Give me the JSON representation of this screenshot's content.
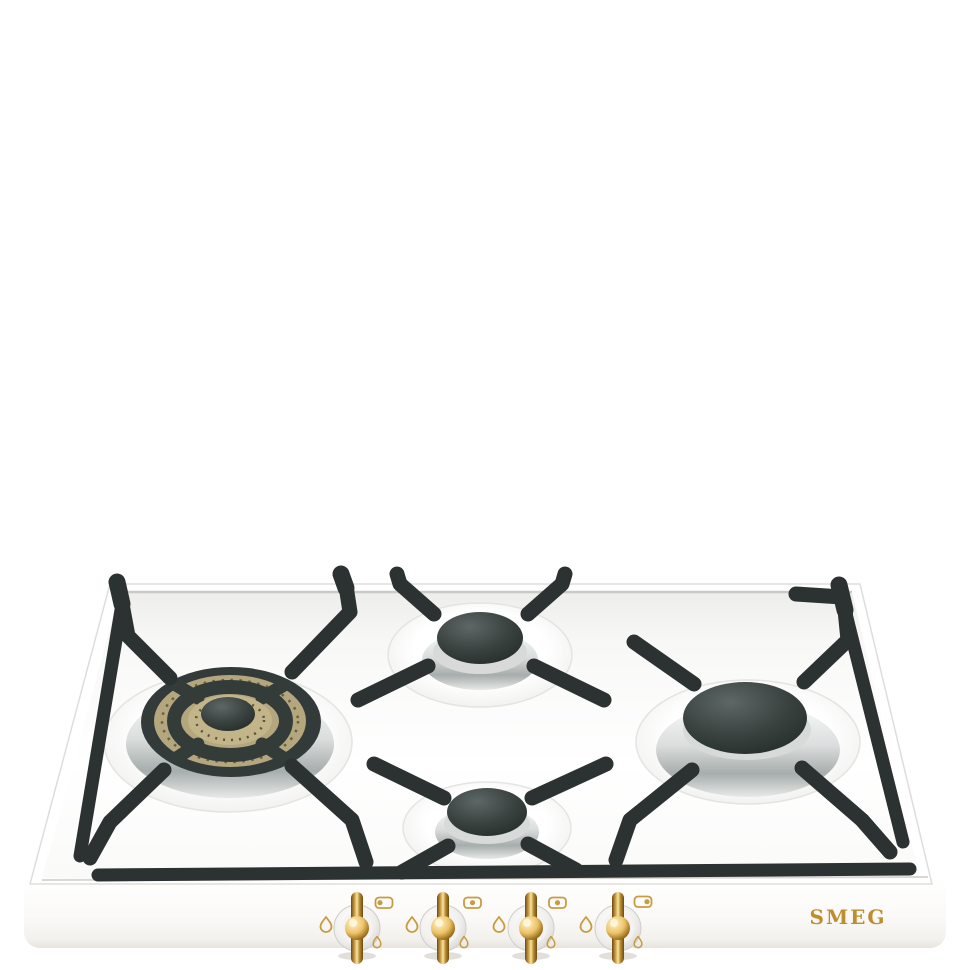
{
  "meta": {
    "type": "product-photo",
    "subject": "4-burner gas hob, white enamel with brass trim and black cast-iron pan supports",
    "background_color": "#ffffff"
  },
  "brand": {
    "logo_text": "SMEG",
    "logo_color": "#bf8d2d"
  },
  "hob": {
    "body_color": "#fbfaf8",
    "surface_color": "#f7f7f6",
    "pan_support_color": "#2c3231",
    "chrome_color": "#c6cac9",
    "burners": [
      {
        "id": "front-left",
        "type": "large triple-ring burner with brass perforated rings",
        "cap_color": "#323a38",
        "brass_color": "#b4a77d"
      },
      {
        "id": "back-center",
        "type": "medium burner, black cap, chrome base",
        "cap_color": "#39413f"
      },
      {
        "id": "front-center",
        "type": "small burner, black cap, chrome base",
        "cap_color": "#39413f"
      },
      {
        "id": "right",
        "type": "large burner, black cap, chrome base",
        "cap_color": "#323a38"
      }
    ]
  },
  "controls": {
    "accent_gold": "#c79c42",
    "knob_style": "white disc with brass bar handle and brass center boss",
    "icon_legend": {
      "large_flame": "maximum flame setting",
      "small_flame": "minimum flame setting",
      "position_box": "burner position indicator"
    },
    "knobs": [
      {
        "id": "knob-1",
        "burner": "front-left",
        "indicator_dot": "left"
      },
      {
        "id": "knob-2",
        "burner": "back-center",
        "indicator_dot": "center"
      },
      {
        "id": "knob-3",
        "burner": "front-center",
        "indicator_dot": "center"
      },
      {
        "id": "knob-4",
        "burner": "right",
        "indicator_dot": "right"
      }
    ]
  }
}
